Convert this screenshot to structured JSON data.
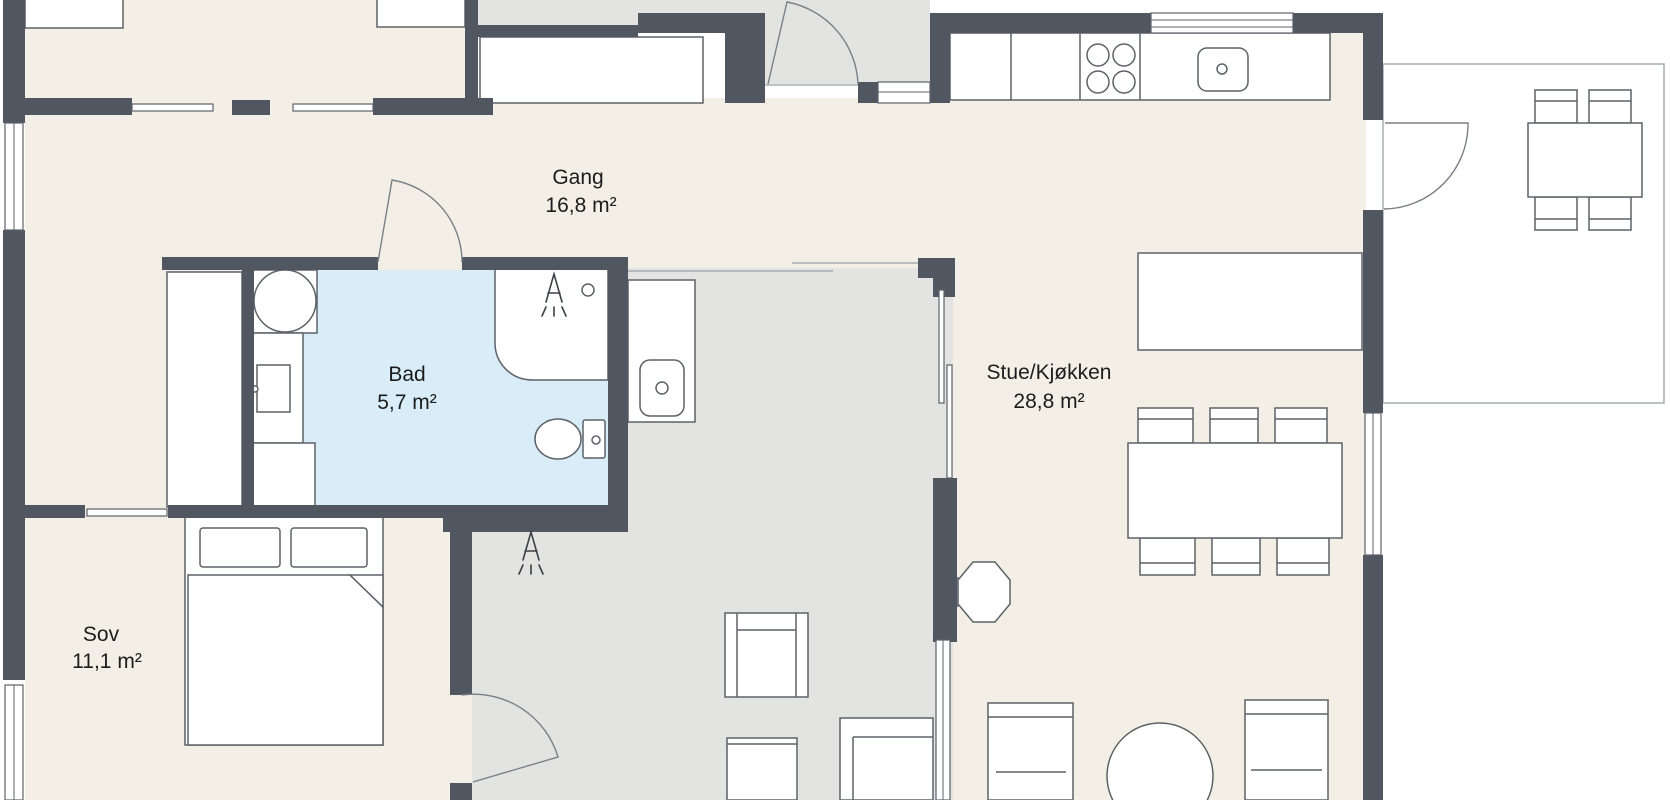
{
  "rooms": {
    "gang": {
      "name": "Gang",
      "area": "16,8 m²"
    },
    "bad": {
      "name": "Bad",
      "area": "5,7 m²"
    },
    "sov": {
      "name": "Sov",
      "area": "11,1 m²"
    },
    "stue": {
      "name": "Stue/Kjøkken",
      "area": "28,8 m²"
    }
  },
  "colors": {
    "wall": "#515760",
    "floor": "#f3efe6",
    "outdoor": "#e3e3e2",
    "wet": "#d9edf8",
    "line": "#5d6269",
    "glass": "#9aa0a5",
    "thin": "#a8adb2",
    "text": "#1c1c1c",
    "bg": "#ffffff"
  }
}
